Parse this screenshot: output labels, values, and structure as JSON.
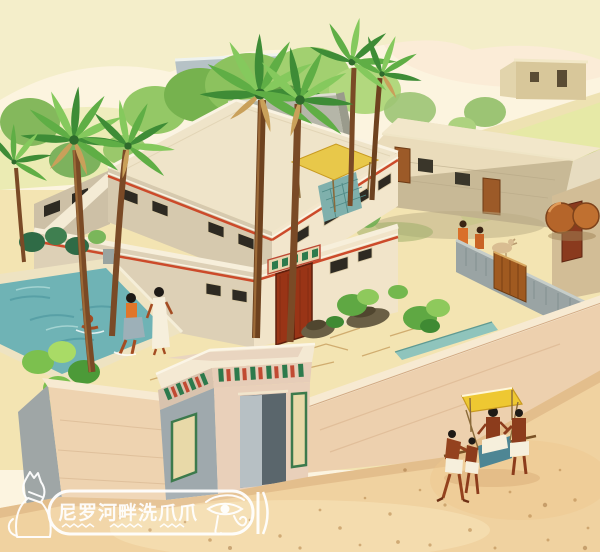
{
  "scene": {
    "subject": "watercolor illustration of an ancient Egyptian villa estate",
    "elements": [
      "main-house",
      "storehouse",
      "gatehouse",
      "perimeter-wall",
      "inner-stone-wall",
      "garden-pool",
      "bathers",
      "palm-trees",
      "garden-beds",
      "stone-statues",
      "pottery-jars",
      "servants",
      "goat",
      "palanquin-procession",
      "desert-sand"
    ]
  },
  "watermark": {
    "text": "尼罗河畔洗爪爪",
    "cat_icon": "egyptian-cat-icon",
    "eye_icon": "eye-of-horus-icon",
    "bar_icon": "cartouche-bar-icon"
  },
  "colors": {
    "sky": "#fcf4e0",
    "hills": "#f1ecc2",
    "foliage": "#7cba52",
    "courtyard": "#f2e2ad",
    "sand": "#f0d2a0",
    "pool": "#6fb3b5",
    "wall": "#eed3b0",
    "house_front": "#f1e4c9",
    "house_shadow": "#d6c9ae",
    "roof": "#efe4c9",
    "trim": "#cc4a2a",
    "door": "#993416",
    "lintel_green": "#2d7a4c",
    "canopy": "#eec832",
    "awning": "#e8c84a",
    "gate_wood": "#a05a20",
    "stone_wall": "#9aa4a4",
    "jar": "#b5652a",
    "skin": "#94421e",
    "kilt": "#f6efdc",
    "watermark": "#ffffff"
  }
}
